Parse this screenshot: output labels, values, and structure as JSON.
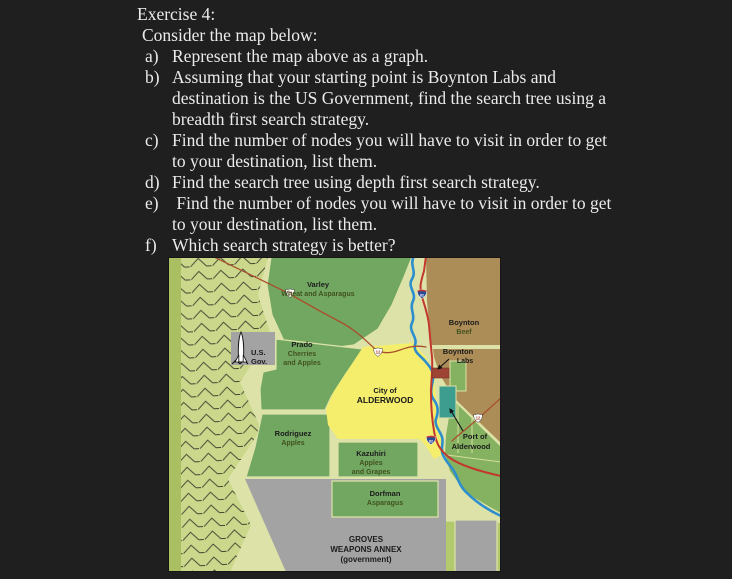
{
  "page": {
    "background": "#1f1f1f",
    "text_color": "#ebebeb"
  },
  "exercise": {
    "title": "Exercise 4:",
    "intro": "Consider the map below:",
    "items": [
      {
        "letter": "a)",
        "lines": [
          "Represent the map above as a graph."
        ]
      },
      {
        "letter": "b)",
        "lines": [
          "Assuming that your starting point is Boynton Labs and",
          "destination is the US Government, find the search tree using a",
          "breadth first search strategy."
        ]
      },
      {
        "letter": "c)",
        "lines": [
          "Find the number of nodes you will have to visit in order to get",
          "to your destination, list them."
        ]
      },
      {
        "letter": "d)",
        "lines": [
          "Find the search tree using depth first search strategy."
        ]
      },
      {
        "letter": "e)",
        "lines": [
          " Find the number of nodes you will have to visit in order to get",
          "to your destination, list them."
        ]
      },
      {
        "letter": "f)",
        "lines": [
          "Which search strategy is better?"
        ]
      }
    ]
  },
  "map": {
    "colors": {
      "base": "#dde3a8",
      "edge_strip": "#a9bf62",
      "mountain": "#cbd78b",
      "hatch": "#3f4732",
      "farm_green": "#72a762",
      "field_green": "#85b260",
      "field_green2": "#b2c96d",
      "city_yellow": "#f5ee6c",
      "ranch_brown": "#ac8d58",
      "gov_gray": "#a3a3a3",
      "labs_red": "#9e4434",
      "port_teal": "#3d9e8f",
      "river_blue": "#2d8ecd",
      "interstate_red": "#c2382e",
      "route_red": "#a8502c",
      "label_dark": "#1b1b1b",
      "crop_olive": "#41521f"
    },
    "regions": {
      "varley": {
        "name": "Varley",
        "crop": "Wheat and Asparagus"
      },
      "boynton_beef": {
        "name": "Boynton",
        "crop": "Beef"
      },
      "boynton_labs": {
        "name": "Boynton",
        "sub": "Labs"
      },
      "prado": {
        "name": "Prado",
        "crop1": "Cherries",
        "crop2": "and Apples"
      },
      "us_gov": {
        "line1": "U.S.",
        "line2": "Gov."
      },
      "alderwood": {
        "line1": "City of",
        "line2": "ALDERWOOD"
      },
      "rodriguez": {
        "name": "Rodriguez",
        "crop": "Apples"
      },
      "kazuhiri": {
        "name": "Kazuhiri",
        "crop1": "Apples",
        "crop2": "and Grapes"
      },
      "dorfman": {
        "name": "Dorfman",
        "crop": "Asparagus"
      },
      "port": {
        "line1": "Port of",
        "line2": "Alderwood"
      },
      "groves": {
        "line1": "GROVES",
        "line2": "WEAPONS ANNEX",
        "line3": "(government)"
      }
    },
    "shields": {
      "us_route": "12",
      "interstate": "82"
    }
  }
}
